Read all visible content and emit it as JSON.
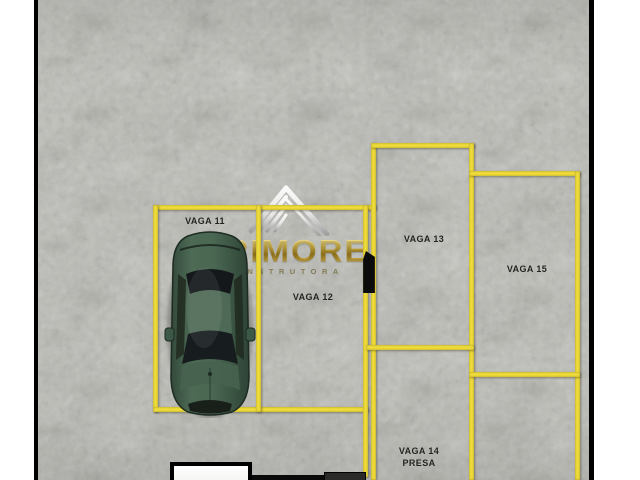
{
  "plan": {
    "type": "parking-floor-plan",
    "background_color": "#bcbcb6",
    "line_color": "#efdd3b",
    "label_color": "#222220",
    "spaces": [
      {
        "id": "vaga-11",
        "label": "VAGA 11",
        "occupied": true
      },
      {
        "id": "vaga-12",
        "label": "VAGA 12",
        "occupied": false
      },
      {
        "id": "vaga-13",
        "label": "VAGA 13",
        "occupied": false
      },
      {
        "id": "vaga-14",
        "label": "VAGA 14",
        "sublabel": "PRESA",
        "occupied": false
      },
      {
        "id": "vaga-15",
        "label": "VAGA 15",
        "occupied": false
      }
    ]
  },
  "watermark": {
    "brand": "PRIMORE",
    "subtitle": "CONSTRUTORA",
    "gold_color": "#c9a62e",
    "icon": "roof-logo-icon"
  },
  "car": {
    "description": "green sedan top view parked in VAGA 11",
    "body_color": "#45614d"
  }
}
